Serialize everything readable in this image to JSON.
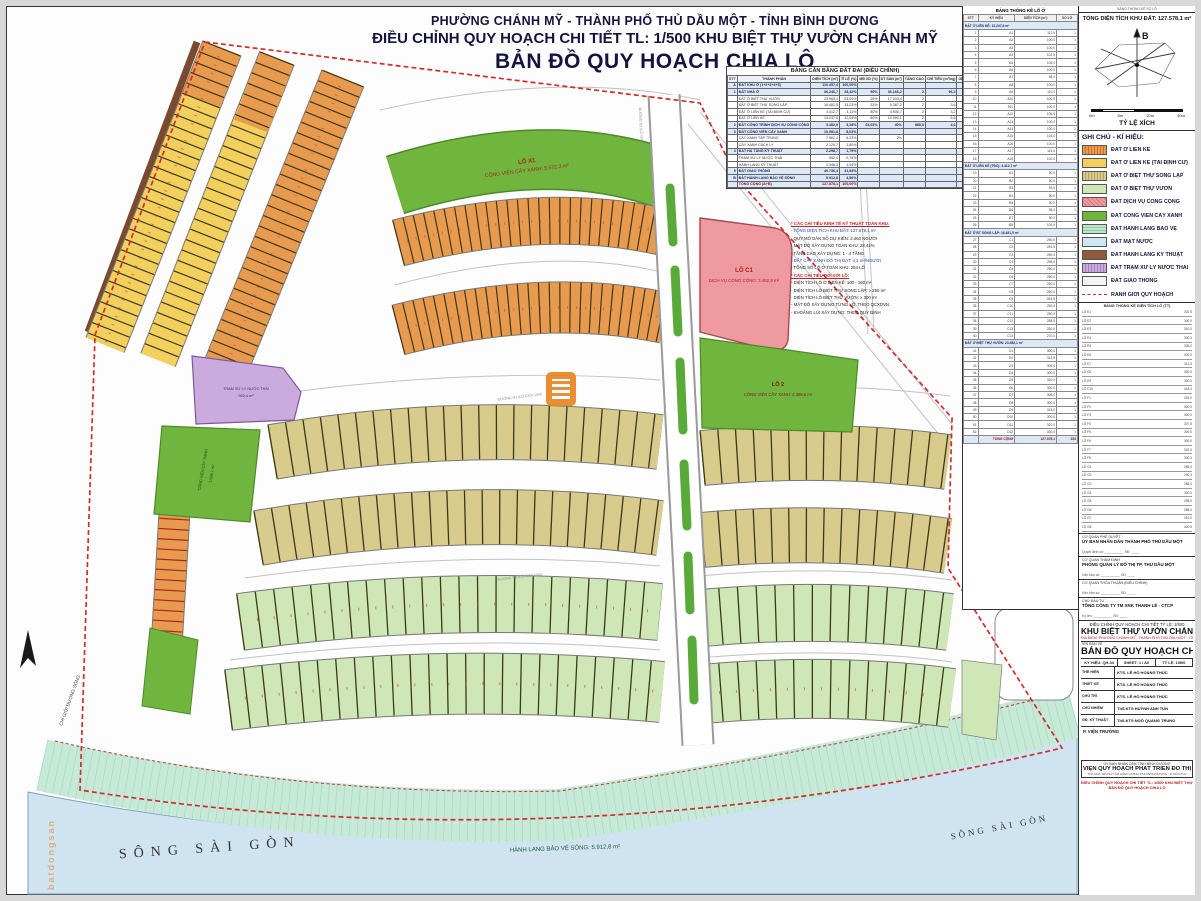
{
  "page": {
    "title_line1": "PHƯỜNG CHÁNH MỸ - THÀNH PHỐ THỦ DẦU MỘT - TỈNH BÌNH DƯƠNG",
    "title_line2": "ĐIỀU CHỈNH QUY HOẠCH CHI TIẾT TL: 1/500 KHU BIỆT THỰ VƯỜN CHÁNH MỸ",
    "title_line3": "BẢN ĐỒ QUY HOẠCH CHIA LÔ"
  },
  "balance_table": {
    "title": "BẢNG CÂN BẰNG ĐẤT ĐAI (ĐIỀU CHỈNH)",
    "headers": [
      "STT",
      "THÀNH PHẦN",
      "DIỆN TÍCH (m²)",
      "TỈ LỆ (%)",
      "MĐ XD (%)",
      "DT SÀN (m²)",
      "TẦNG CAO",
      "CHỈ TIÊU (m²/ng)",
      "GHI CHÚ"
    ],
    "rows": [
      {
        "c": [
          "A",
          "ĐẤT KHU Ở (1+2+3+4+5)",
          "110.457,4",
          "100,00%",
          "",
          "",
          "",
          "",
          "153,1"
        ],
        "hl": true
      },
      {
        "c": [
          "1",
          "ĐẤT NHÀ Ở",
          "36.246,7",
          "28,42%",
          "90%",
          "36.166,2",
          "2",
          "96,2",
          ""
        ],
        "hl": true
      },
      {
        "c": [
          "",
          "ĐẤT Ở BIỆT THỰ VƯỜN",
          "23.983,1",
          "23,00%",
          "25%",
          "17.033,4",
          "2",
          "",
          ""
        ]
      },
      {
        "c": [
          "",
          "ĐẤT Ở BIỆT THỰ SONG LẬP",
          "16.481,5",
          "15,23%",
          "33%",
          "5.387,2",
          "2",
          "3,6",
          ""
        ]
      },
      {
        "c": [
          "",
          "ĐẤT Ở LIÊN KẾ (TÁI ĐỊNH CƯ)",
          "4.412,7",
          "4,11%",
          "80%",
          "4.936,7",
          "2",
          "3,2",
          ""
        ]
      },
      {
        "c": [
          "",
          "ĐẤT Ở LIÊN KẾ",
          "13.247,6",
          "12,04%",
          "80%",
          "10.590,1",
          "2",
          "6,6",
          ""
        ]
      },
      {
        "c": [
          "2",
          "ĐẤT CÔNG TRÌNH DỊCH VỤ CÔNG CỘNG",
          "3.482,9",
          "3,28%",
          "63,03%",
          "40%",
          "880,0",
          "4,0",
          "7,2"
        ],
        "hl": true
      },
      {
        "c": [
          "3",
          "ĐẤT CÔNG VIÊN CÂY XANH",
          "10.081,8",
          "8,03%",
          "",
          "",
          "",
          "",
          "8,3"
        ],
        "hl": true
      },
      {
        "c": [
          "",
          "CÂY XANH TẬP TRUNG",
          "7.961,1",
          "6,23%",
          "",
          "2%",
          "",
          "",
          ""
        ]
      },
      {
        "c": [
          "",
          "CÂY XANH CÁCH LY",
          "2.120,7",
          "1,80%",
          "",
          "",
          "",
          "",
          ""
        ]
      },
      {
        "c": [
          "4",
          "ĐẤT HẠ TẦNG KỸ THUẬT",
          "2.298,7",
          "1,79%",
          "",
          "",
          "",
          "",
          "1,8"
        ],
        "hl": true
      },
      {
        "c": [
          "",
          "TRẠM XỬ LÝ NƯỚC THẢI",
          "952,4",
          "0,75%",
          "",
          "",
          "",
          "",
          ""
        ]
      },
      {
        "c": [
          "",
          "HÀNH LANG KỸ THUẬT",
          "1.346,3",
          "1,04%",
          "",
          "",
          "",
          "",
          ""
        ]
      },
      {
        "c": [
          "5",
          "ĐẤT GIAO THÔNG",
          "40.736,4",
          "31,93%",
          "",
          "",
          "",
          "",
          "40,2"
        ],
        "hl": true
      },
      {
        "c": [
          "B",
          "ĐẤT HÀNH LANG BẢO VỆ SÔNG",
          "5.912,8",
          "4,56%",
          "",
          "",
          "",
          "",
          ""
        ],
        "hl": true
      },
      {
        "c": [
          "",
          "TỔNG CỘNG (A+B)",
          "127.578,1",
          "100,00%",
          "",
          "",
          "",
          "",
          ""
        ],
        "hl": true,
        "b": true
      }
    ]
  },
  "notes": {
    "lines": [
      {
        "t": "* CÁC CHỈ TIÊU KINH TẾ KỸ THUẬT TOÀN KHU:",
        "c": "nred"
      },
      {
        "t": "- TỔNG DIỆN TÍCH KHU ĐẤT: 127.578,1 m²",
        "c": "nblue"
      },
      {
        "t": "- QUY MÔ DÂN SỐ DỰ KIẾN: 2.460 NGƯỜI",
        "c": "nblk"
      },
      {
        "t": "- MẬT ĐỘ XÂY DỰNG TOÀN KHU: 28,42%",
        "c": "nblk"
      },
      {
        "t": "- TẦNG CAO XÂY DỰNG: 1 - 4 TẦNG",
        "c": "nblk"
      },
      {
        "t": "- ĐẤT CÂY XANH ĐÔ THỊ ĐẠT: 4,1 m²/NGƯỜI",
        "c": "nblue"
      },
      {
        "t": "- TỔNG SỐ LÔ Ở TOÀN KHU: 254 LÔ",
        "c": "nblk"
      },
      {
        "t": "* CÁC CHỈ TIÊU ĐỐI VỚI LÔ:",
        "c": "nred"
      },
      {
        "t": "- DIỆN TÍCH LÔ Ở LIÊN KẾ: 100 - 160 m²",
        "c": "nblk"
      },
      {
        "t": "- DIỆN TÍCH LÔ BIỆT THỰ SONG LẬP: ≥ 250 m²",
        "c": "nblk"
      },
      {
        "t": "- DIỆN TÍCH LÔ BIỆT THỰ VƯỜN: ≥ 300 m²",
        "c": "nblk"
      },
      {
        "t": "- MẬT ĐỘ XÂY DỰNG TỪNG LÔ: THEO QCXDVN",
        "c": "nblk"
      },
      {
        "t": "- KHOẢNG LÙI XÂY DỰNG: THEO QUY ĐỊNH",
        "c": "nblk"
      }
    ]
  },
  "stats_table": {
    "title": "BẢNG THỐNG KÊ LÔ Ở",
    "headers": [
      "STT",
      "KÝ HIỆU",
      "DIỆN TÍCH (m²)",
      "SỐ LÔ"
    ],
    "rows": [
      {
        "c": [
          "",
          "ĐẤT Ở LIÊN KẾ: 13.247,6 m²",
          "",
          ""
        ],
        "sec": true
      },
      {
        "c": [
          "1",
          "A1",
          "112,5",
          "1"
        ]
      },
      {
        "c": [
          "2",
          "A2",
          "100,0",
          "1"
        ]
      },
      {
        "c": [
          "3",
          "A3",
          "100,0",
          "1"
        ]
      },
      {
        "c": [
          "4",
          "A4",
          "102,5",
          "1"
        ]
      },
      {
        "c": [
          "5",
          "A5",
          "105,0",
          "1"
        ]
      },
      {
        "c": [
          "6",
          "A6",
          "100,0",
          "1"
        ]
      },
      {
        "c": [
          "7",
          "A7",
          "98,0",
          "1"
        ]
      },
      {
        "c": [
          "8",
          "A8",
          "100,0",
          "1"
        ]
      },
      {
        "c": [
          "9",
          "A9",
          "110,0",
          "1"
        ]
      },
      {
        "c": [
          "10",
          "A10",
          "100,0",
          "1"
        ]
      },
      {
        "c": [
          "11",
          "A11",
          "100,0",
          "1"
        ]
      },
      {
        "c": [
          "12",
          "A12",
          "106,5",
          "1"
        ]
      },
      {
        "c": [
          "13",
          "A13",
          "100,0",
          "1"
        ]
      },
      {
        "c": [
          "14",
          "A14",
          "100,0",
          "1"
        ]
      },
      {
        "c": [
          "15",
          "A15",
          "104,0",
          "1"
        ]
      },
      {
        "c": [
          "16",
          "A16",
          "100,0",
          "1"
        ]
      },
      {
        "c": [
          "17",
          "A17",
          "115,0",
          "1"
        ]
      },
      {
        "c": [
          "18",
          "A18",
          "120,0",
          "1"
        ]
      },
      {
        "c": [
          "",
          "ĐẤT Ở LIÊN KẾ (TĐC): 4.412,7 m²",
          "",
          ""
        ],
        "sec": true
      },
      {
        "c": [
          "19",
          "B1",
          "90,0",
          "1"
        ]
      },
      {
        "c": [
          "20",
          "B2",
          "90,0",
          "1"
        ]
      },
      {
        "c": [
          "21",
          "B3",
          "92,5",
          "1"
        ]
      },
      {
        "c": [
          "22",
          "B4",
          "90,0",
          "1"
        ]
      },
      {
        "c": [
          "23",
          "B5",
          "90,0",
          "1"
        ]
      },
      {
        "c": [
          "24",
          "B6",
          "95,0",
          "1"
        ]
      },
      {
        "c": [
          "25",
          "B7",
          "90,0",
          "1"
        ]
      },
      {
        "c": [
          "26",
          "B8",
          "105,0",
          "1"
        ]
      },
      {
        "c": [
          "",
          "ĐẤT Ở BT SONG LẬP: 16.481,5 m²",
          "",
          ""
        ],
        "sec": true
      },
      {
        "c": [
          "27",
          "C1",
          "250,0",
          "1"
        ]
      },
      {
        "c": [
          "28",
          "C2",
          "252,5",
          "1"
        ]
      },
      {
        "c": [
          "29",
          "C3",
          "250,0",
          "1"
        ]
      },
      {
        "c": [
          "30",
          "C4",
          "255,0",
          "1"
        ]
      },
      {
        "c": [
          "31",
          "C5",
          "250,0",
          "1"
        ]
      },
      {
        "c": [
          "32",
          "C6",
          "260,0",
          "1"
        ]
      },
      {
        "c": [
          "33",
          "C7",
          "250,0",
          "1"
        ]
      },
      {
        "c": [
          "34",
          "C8",
          "250,0",
          "1"
        ]
      },
      {
        "c": [
          "35",
          "C9",
          "262,5",
          "1"
        ]
      },
      {
        "c": [
          "36",
          "C10",
          "250,0",
          "1"
        ]
      },
      {
        "c": [
          "37",
          "C11",
          "250,0",
          "1"
        ]
      },
      {
        "c": [
          "38",
          "C12",
          "258,0",
          "1"
        ]
      },
      {
        "c": [
          "39",
          "C13",
          "250,0",
          "1"
        ]
      },
      {
        "c": [
          "40",
          "C14",
          "270,0",
          "1"
        ]
      },
      {
        "c": [
          "",
          "ĐẤT Ở BIỆT THỰ VƯỜN: 23.983,1 m²",
          "",
          ""
        ],
        "sec": true
      },
      {
        "c": [
          "41",
          "D1",
          "300,0",
          "1"
        ]
      },
      {
        "c": [
          "42",
          "D2",
          "312,5",
          "1"
        ]
      },
      {
        "c": [
          "43",
          "D3",
          "305,0",
          "1"
        ]
      },
      {
        "c": [
          "44",
          "D4",
          "300,0",
          "1"
        ]
      },
      {
        "c": [
          "45",
          "D5",
          "320,0",
          "1"
        ]
      },
      {
        "c": [
          "46",
          "D6",
          "300,0",
          "1"
        ]
      },
      {
        "c": [
          "47",
          "D7",
          "308,0",
          "1"
        ]
      },
      {
        "c": [
          "48",
          "D8",
          "300,0",
          "1"
        ]
      },
      {
        "c": [
          "49",
          "D9",
          "315,0",
          "1"
        ]
      },
      {
        "c": [
          "50",
          "D10",
          "300,0",
          "1"
        ]
      },
      {
        "c": [
          "51",
          "D11",
          "310,0",
          "1"
        ]
      },
      {
        "c": [
          "52",
          "D12",
          "330,0",
          "1"
        ]
      },
      {
        "c": [
          "",
          "TỔNG CỘNG",
          "127.578,1",
          "254"
        ],
        "tot": true
      }
    ]
  },
  "right_col": {
    "mini_header": "BẢNG THỐNG KÊ SỐ LÔ",
    "total_area": "TỔNG DIỆN TÍCH KHU ĐẤT: 127.578,1 m²",
    "compass_label": "B",
    "scale_title": "TỶ LỆ XÍCH",
    "scale_ticks": [
      "0m",
      "5m",
      "20m",
      "40m"
    ]
  },
  "legend": {
    "title": "GHI CHÚ - KÍ HIỆU:",
    "items": [
      {
        "key": "sw-lk",
        "label": "ĐẤT Ở LIÊN KẾ"
      },
      {
        "key": "sw-tdc",
        "label": "ĐẤT Ở LIÊN KẾ (TÁI ĐỊNH CƯ)"
      },
      {
        "key": "sw-bsl",
        "label": "ĐẤT Ở BIỆT THỰ SONG LẬP"
      },
      {
        "key": "sw-btv",
        "label": "ĐẤT Ở BIỆT THỰ VƯỜN"
      },
      {
        "key": "sw-dvcc",
        "label": "ĐẤT DỊCH VỤ CÔNG CỘNG"
      },
      {
        "key": "sw-cvx",
        "label": "ĐẤT CÔNG VIÊN CÂY XANH"
      },
      {
        "key": "sw-hlbv",
        "label": "ĐẤT HÀNH LANG BẢO VỆ"
      },
      {
        "key": "sw-mn",
        "label": "ĐẤT MẶT NƯỚC"
      },
      {
        "key": "sw-hlkt",
        "label": "ĐẤT HÀNH LANG KỸ THUẬT"
      },
      {
        "key": "sw-txl",
        "label": "ĐẤT TRẠM XỬ LÝ NƯỚC THẢI"
      },
      {
        "key": "sw-gt",
        "label": "ĐẤT GIAO THÔNG"
      },
      {
        "key": "sw-rg",
        "label": "RANH GIỚI QUY HOẠCH"
      }
    ]
  },
  "cont_table": {
    "title": "BẢNG THỐNG KÊ DIỆN TÍCH LÔ (TT)",
    "rows": [
      [
        "LÔ E1",
        "302,5"
      ],
      [
        "LÔ E2",
        "300,0"
      ],
      [
        "LÔ E3",
        "310,0"
      ],
      [
        "LÔ E4",
        "300,0"
      ],
      [
        "LÔ E5",
        "305,0"
      ],
      [
        "LÔ E6",
        "300,0"
      ],
      [
        "LÔ E7",
        "312,5"
      ],
      [
        "LÔ E8",
        "300,0"
      ],
      [
        "LÔ E9",
        "300,0"
      ],
      [
        "LÔ E10",
        "318,0"
      ],
      [
        "LÔ F1",
        "325,0"
      ],
      [
        "LÔ F2",
        "300,0"
      ],
      [
        "LÔ F3",
        "300,0"
      ],
      [
        "LÔ F4",
        "307,5"
      ],
      [
        "LÔ F5",
        "300,0"
      ],
      [
        "LÔ F6",
        "300,0"
      ],
      [
        "LÔ F7",
        "322,0"
      ],
      [
        "LÔ F8",
        "300,0"
      ],
      [
        "LÔ G1",
        "285,0"
      ],
      [
        "LÔ G2",
        "290,0"
      ],
      [
        "LÔ G3",
        "285,0"
      ],
      [
        "LÔ G4",
        "300,0"
      ],
      [
        "LÔ G5",
        "295,0"
      ],
      [
        "LÔ G6",
        "285,0"
      ],
      [
        "LÔ G7",
        "310,0"
      ],
      [
        "LÔ G8",
        "420,5"
      ]
    ]
  },
  "agencies": {
    "blocks": [
      {
        "label": "CƠ QUAN PHÊ DUYỆT",
        "name": "ỦY BAN NHÂN DÂN THÀNH PHỐ THỦ DẦU MỘT",
        "sig": "Quyết định số: __________  SĐ: ____"
      },
      {
        "label": "CƠ QUAN THẨM ĐỊNH",
        "name": "PHÒNG QUẢN LÝ ĐÔ THỊ TP. THỦ DẦU MỘT",
        "sig": "Văn bản số: __________  SĐ: ____"
      },
      {
        "label": "CƠ QUAN THỎA THUẬN (ĐIỀU CHỈNH)",
        "name": "",
        "sig": "Văn bản số: __________  SĐ: ____"
      },
      {
        "label": "CHỦ ĐẦU TƯ",
        "name": "TỔNG CÔNG TY TM XNK THANH LỄ - CTCP",
        "sig": "Ký tên: __________  SĐ: ____"
      }
    ]
  },
  "title_block": {
    "r1": "ĐIỀU CHỈNH QUY HOẠCH CHI TIẾT TỶ LỆ: 1/500",
    "r2": "KHU BIỆT THỰ VƯỜN CHÁNH MỸ",
    "r3": "ĐỊA ĐIỂM: PHƯỜNG CHÁNH MỸ - THÀNH PHỐ THỦ DẦU MỘT - TỈNH BÌNH DƯƠNG",
    "r4": "TÊN BẢN VẼ",
    "r5": "BẢN ĐỒ QUY HOẠCH CHIA LÔ",
    "m1": "KÝ HIỆU: QH-04",
    "m2": "SHEET: 1 / A0",
    "m3": "TỶ LỆ: 1/500",
    "crew": [
      {
        "l": "THỂ HIỆN",
        "n": "KTS. LÊ HỒ HOÀNG THÚC"
      },
      {
        "l": "THIẾT KẾ",
        "n": "KTS. LÊ HỒ HOÀNG THÚC"
      },
      {
        "l": "CHỦ TRÌ",
        "n": "KTS. LÊ HỒ HOÀNG THÚC"
      },
      {
        "l": "CHỦ NHIỆM",
        "n": "ThS.KTS HUỲNH ANH TÚN"
      },
      {
        "l": "GĐ. KỸ THUẬT",
        "n": "ThS.KTS NGÔ QUANG TRUNG"
      }
    ],
    "pvt": "P. VIỆN TRƯỞNG",
    "inst1": "ỦY BAN NHÂN DÂN TỈNH BÌNH DƯƠNG",
    "inst2": "VIỆN QUY HOẠCH PHÁT TRIỂN ĐÔ THỊ",
    "inst3": "TÒA NHÀ TRUNG TÂM HÀNH CHÍNH TỈNH BÌNH DƯƠNG - P. HÒA PHÚ",
    "rf1": "ĐIỀU CHỈNH QUY HOẠCH CHI TIẾT TL: 1/500 KHU BIỆT THỰ VƯỜN CHÁNH MỸ",
    "rf2": "BẢN ĐỒ QUY HOẠCH CHIA LÔ"
  },
  "map": {
    "labels": {
      "park1_lo": "LÔ X1",
      "park1_name": "CÔNG VIÊN CÂY XANH: 5.572,3 m²",
      "c1_lo": "LÔ C1",
      "c1_name": "DỊCH VỤ CÔNG CỘNG: 3.482,9 m²",
      "park2_lo": "LÔ 2",
      "park2_name": "CÔNG VIÊN CÂY XANH: 2.389,6 m²",
      "txl1": "TRẠM XỬ LÝ NƯỚC THẢI",
      "txl2": "952,4 m²",
      "cvx_left1": "CÔNG VIÊN CÂY XANH",
      "cvx_left2": "1.568,7 m²",
      "hlbv": "HÀNH LANG BẢO VỆ SÔNG: 5.912,8 m²",
      "river_left": "SÔNG  SÀI  GÒN",
      "river_right": "SÔNG  SÀI  GÒN",
      "cgds": "CHỈ GIỚI ĐƯỜNG SÔNG",
      "road1": "ĐƯỜNG D1 (LỘ GIỚI 20m)",
      "road2": "ĐƯỜNG N3 (LỘ GIỚI 13m)",
      "road3": "ĐƯỜNG N5 (LỘ GIỚI 13m)"
    },
    "watermark": "batdongsan"
  }
}
